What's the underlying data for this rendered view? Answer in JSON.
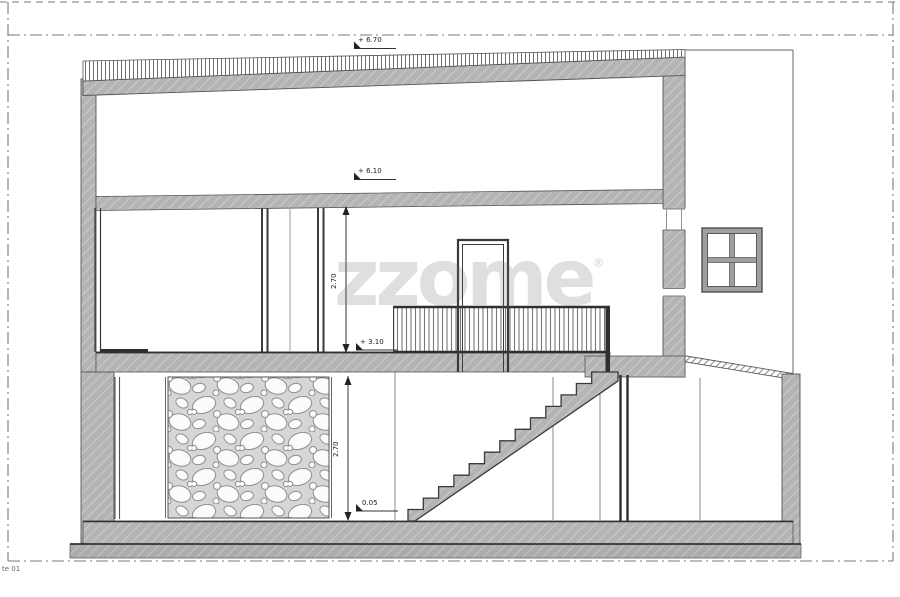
{
  "sheet": {
    "corner_label": "te 01"
  },
  "watermark": {
    "text": "zzome",
    "mark": "®"
  },
  "levels": {
    "roof": "+ 6.70",
    "attic_slab": "+ 6.10",
    "upper_floor": "+ 3.10",
    "ground_floor": "0.05"
  },
  "dimensions": {
    "upper_floor_height": "2.70",
    "ground_floor_height": "2.70"
  },
  "drawing": {
    "stair_steps": 13
  },
  "colors": {
    "wall_fill": "#b4b4b4",
    "line_dark": "#3a3a3a",
    "frame_dash": "#777777"
  }
}
